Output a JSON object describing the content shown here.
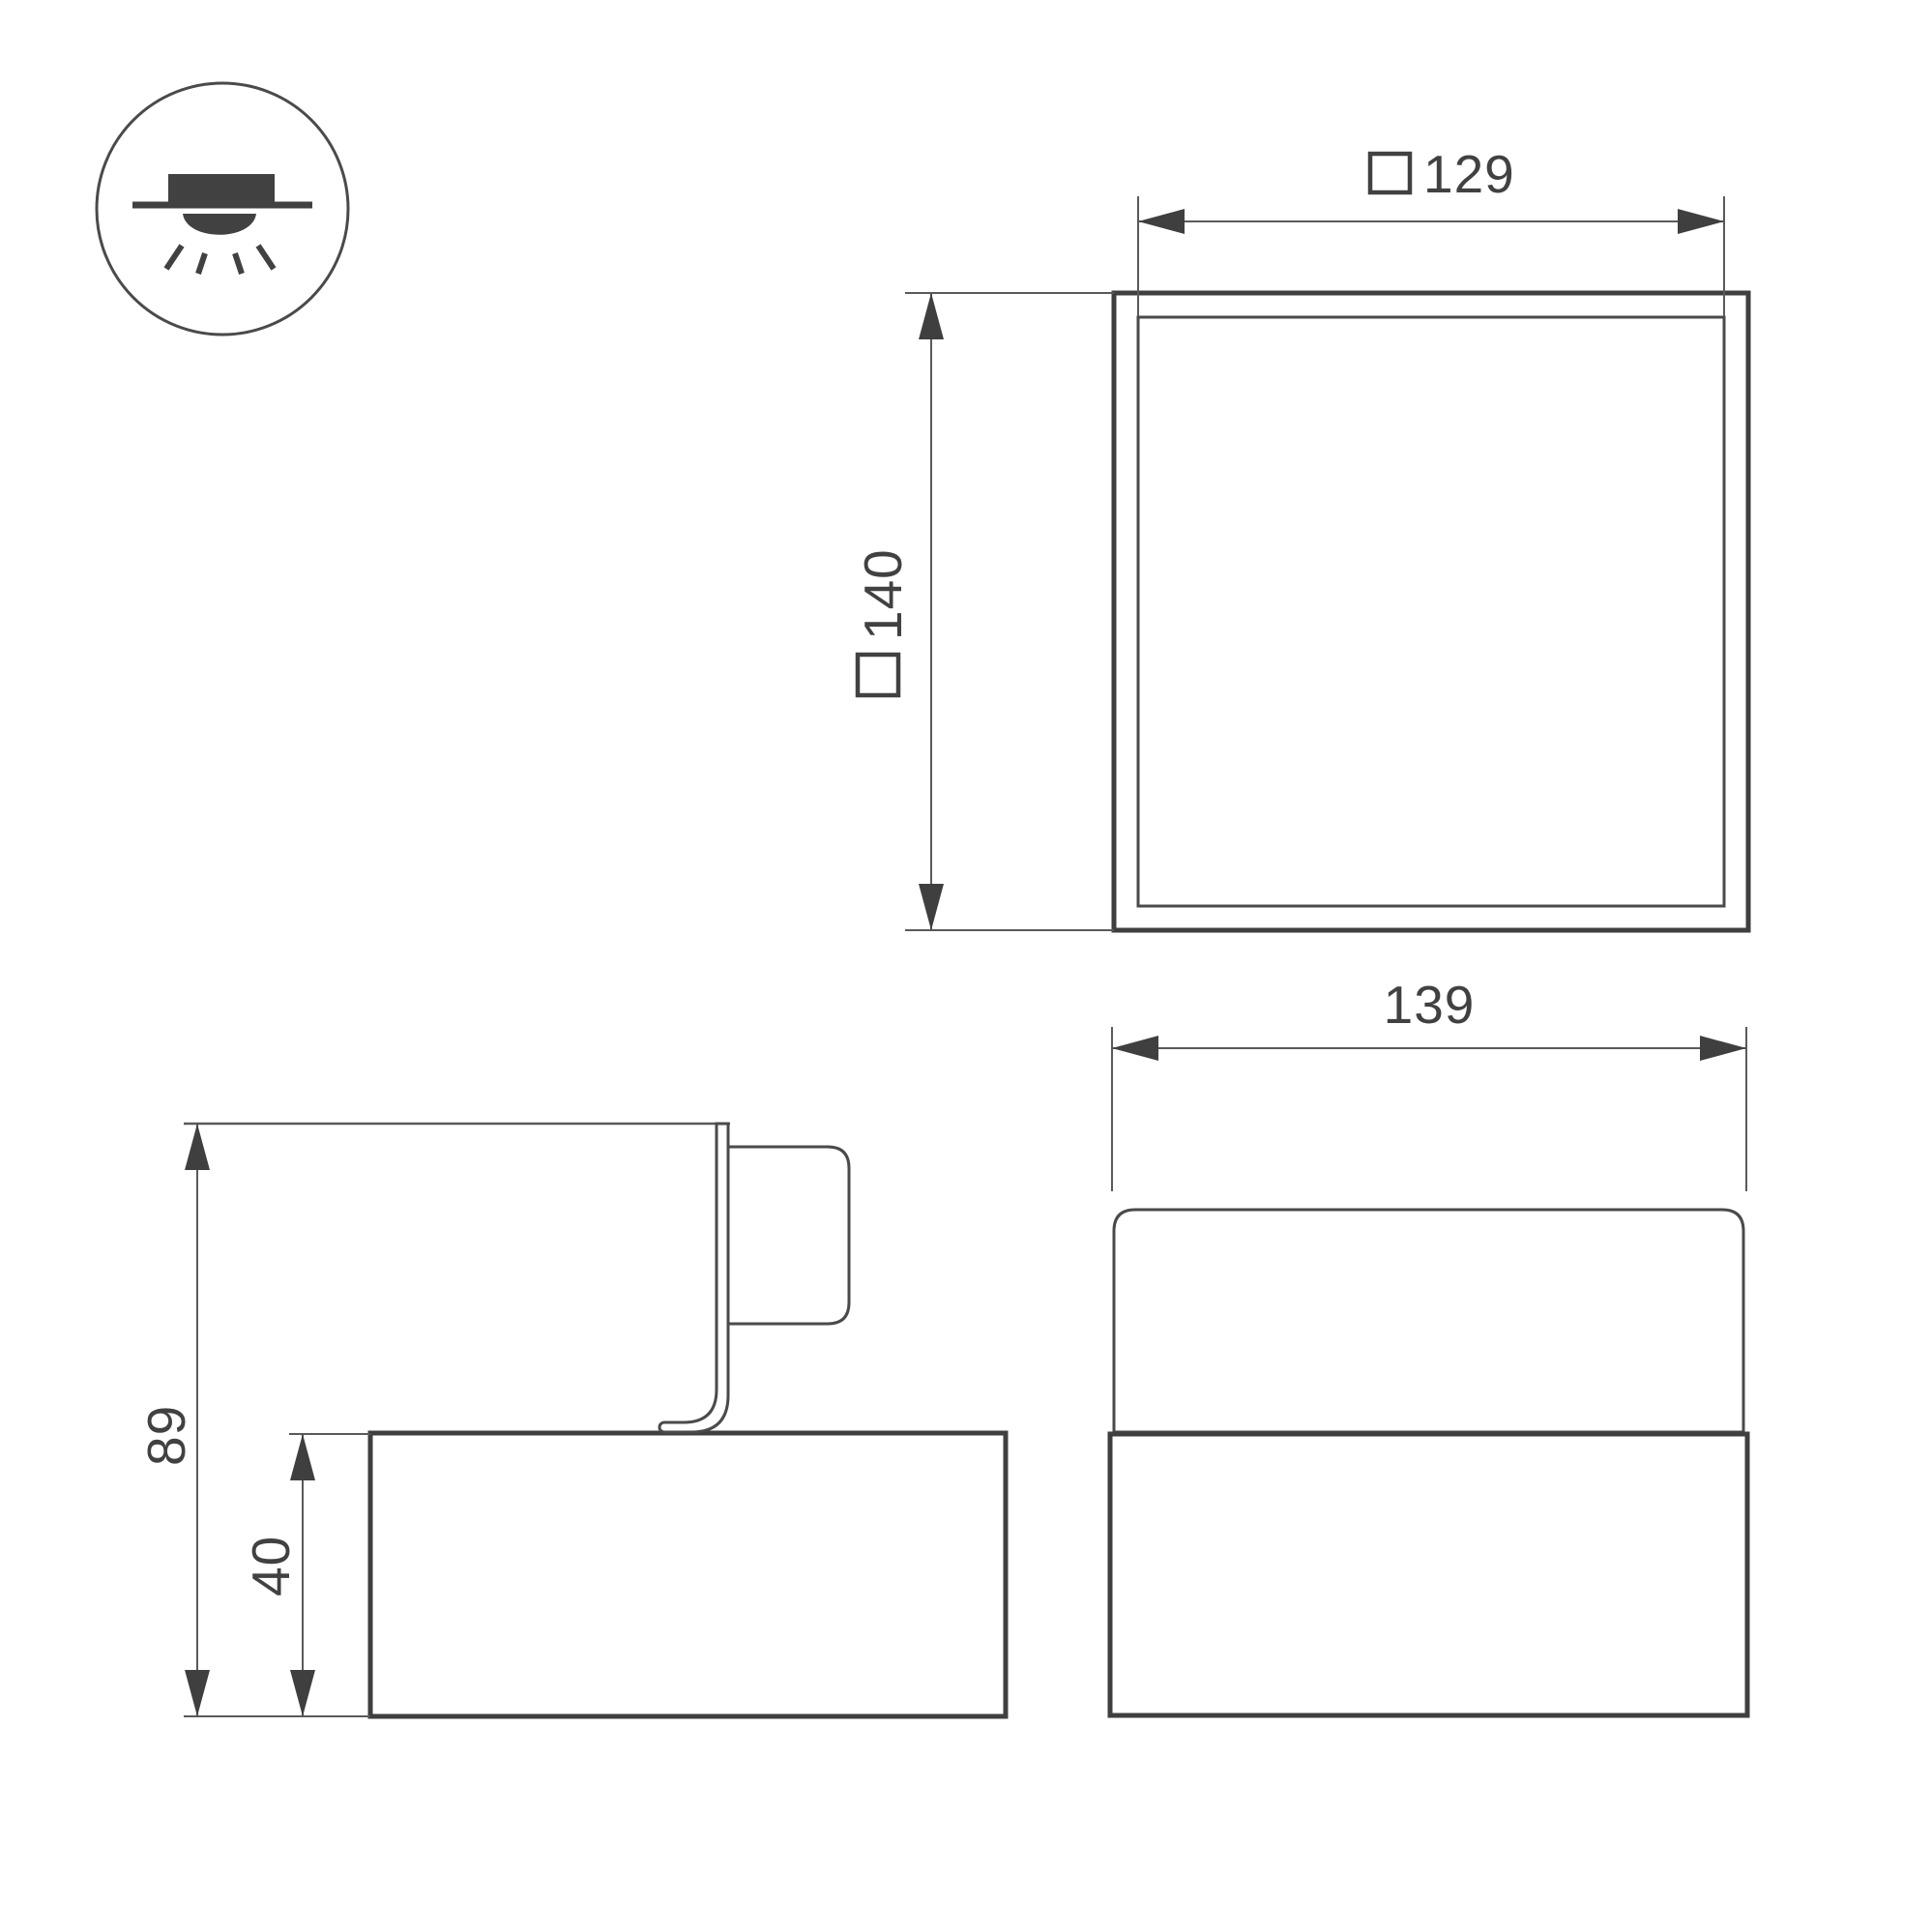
{
  "drawing": {
    "title": "luminaire-dimension-drawing",
    "icon": {
      "meaning": "surface-mounted-downlight"
    },
    "top_view": {
      "inner_width": {
        "symbol": "square",
        "value": "129"
      },
      "outer_height": {
        "symbol": "square",
        "value": "140"
      }
    },
    "side_view": {
      "total_height": {
        "value": "89"
      },
      "base_height": {
        "value": "40"
      }
    },
    "front_view": {
      "width": {
        "value": "139"
      }
    },
    "colors": {
      "thick_outline": "#3f3f3f",
      "medium_outline": "#4a4a4a",
      "dimension_line": "#5a5a5a",
      "text": "#414141",
      "background": "#ffffff"
    }
  }
}
